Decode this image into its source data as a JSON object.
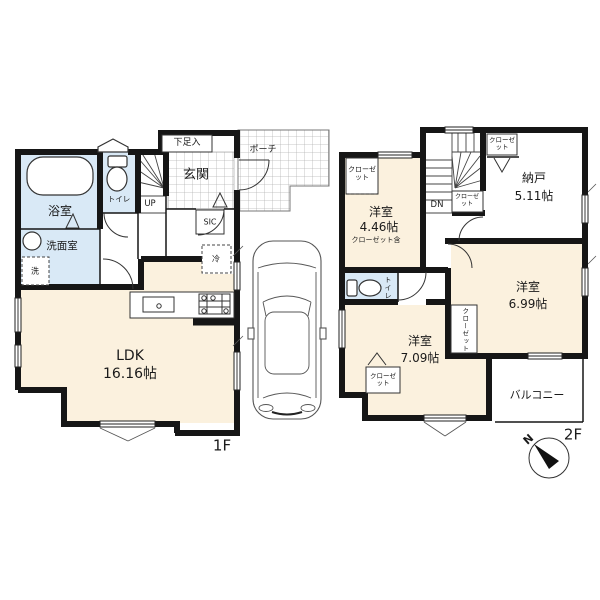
{
  "colors": {
    "wall": "#161616",
    "room_cream": "#fbf1de",
    "wet_area_blue": "#d9e9f6",
    "background": "#ffffff"
  },
  "floor1": {
    "label": "1F",
    "rooms": {
      "ldk": {
        "name": "LDK",
        "size": "16.16帖"
      },
      "bathroom": {
        "name": "浴室"
      },
      "washroom": {
        "name": "洗面室"
      },
      "toilet": {
        "name": "トイレ"
      },
      "entrance": {
        "name": "玄関"
      },
      "shoe_cabinet": {
        "name": "下足入"
      },
      "shoe_closet": {
        "name": "SIC"
      },
      "porch": {
        "name": "ポーチ"
      }
    },
    "annotations": {
      "stairs_up": "UP",
      "refrigerator": "冷",
      "washer": "洗"
    }
  },
  "floor2": {
    "label": "2F",
    "rooms": {
      "bedroom_446": {
        "name": "洋室",
        "size": "4.46帖",
        "note": "クローゼット含"
      },
      "storage": {
        "name": "納戸",
        "size": "5.11帖"
      },
      "bedroom_699": {
        "name": "洋室",
        "size": "6.99帖"
      },
      "bedroom_709": {
        "name": "洋室",
        "size": "7.09帖"
      },
      "balcony": {
        "name": "バルコニー"
      },
      "toilet": {
        "name": "トイレ"
      }
    },
    "annotations": {
      "stairs_down": "DN",
      "closet": "クローゼット"
    }
  },
  "compass": {
    "north": "N"
  }
}
